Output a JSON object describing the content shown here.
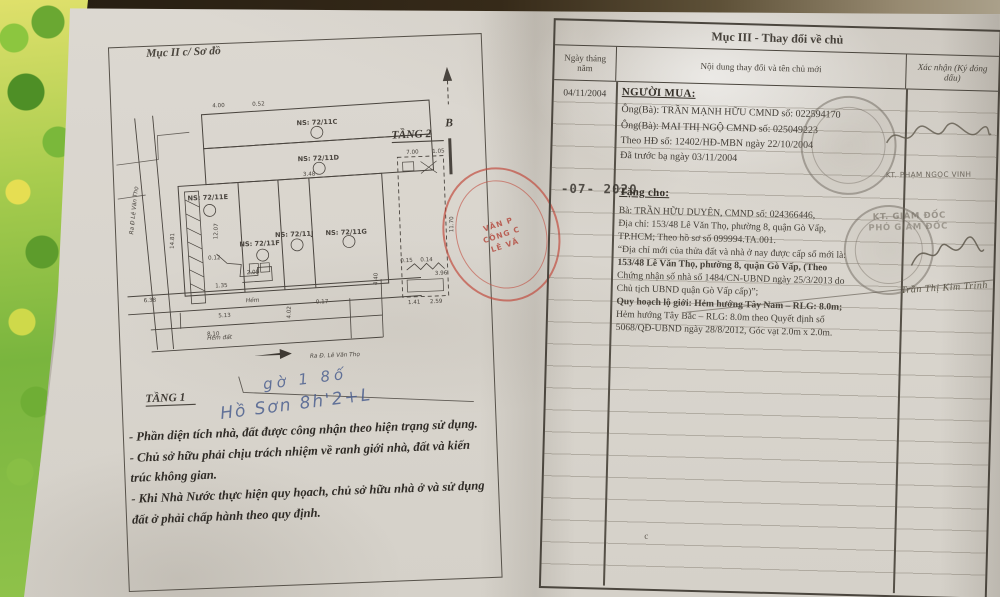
{
  "colors": {
    "paper": "#dcd8d1",
    "ink": "#3f3a33",
    "table_line": "#4b463e",
    "stamp_red": "#bf4a3f",
    "stamp_gray": "#7d776b",
    "handwriting_blue": "#44598c",
    "background_green": "#79b53e",
    "background_yellow": "#e4d94e"
  },
  "left_page": {
    "section_title": "Mục II c/ Sơ đồ",
    "floor1_label": "TẦNG 1",
    "floor2_label": "TẦNG 2",
    "north_label": "B",
    "street_label": "Ra Đ. Lê Văn Thọ",
    "road_label_vertical": "Ra Đ Lê Văn Thọ",
    "alley_label": "Hẻm",
    "alley_dirt_label": "Hẻm  đất",
    "rooms": [
      "NS: 72/11C",
      "NS: 72/11D",
      "NS: 72/11E",
      "NS: 72/11F",
      "NS: 72/11J",
      "NS: 72/11G"
    ],
    "dims": [
      "4.00",
      "0.52",
      "3.48",
      "14.81",
      "12.07",
      "6.38",
      "5.13",
      "0.17",
      "2.05",
      "1.35",
      "0.12",
      "4.02",
      "7.00",
      "1.05",
      "11.70",
      "0.15",
      "0.14",
      "3.96",
      "1.41",
      "2.59",
      "8.10",
      "4.40"
    ],
    "handwriting": [
      "gờ 1 8ố",
      "Hồ Sơn 8h'2+L"
    ],
    "stamp_partial_lines": [
      "VĂN P",
      "CÔNG C",
      "LÊ VĂ"
    ],
    "notes": [
      "- Phần diện tích nhà, đất được công nhận theo hiện trạng sử dụng.",
      "- Chủ sở hữu phải chịu trách nhiệm về ranh giới nhà, đất và kiến trúc không gian.",
      "- Khi Nhà Nước thực hiện quy họach, chủ sở hữu nhà ở và sử dụng đất ở phải chấp hành theo quy định."
    ]
  },
  "right_page": {
    "section_title": "Mục III - Thay đổi về chủ",
    "columns": [
      "Ngày tháng năm",
      "Nội dung thay đổi và tên chủ mới",
      "Xác nhận (Ký đóng dấu)"
    ],
    "stray_mark": "c",
    "entries": [
      {
        "date": "04/11/2004",
        "heading": "NGƯỜI MUA:",
        "lines": [
          "Ông(Bà): TRẦN MẠNH HỮU   CMND số: 022594170",
          "Ông(Bà): MAI THỊ NGỘ        CMND số: 025049223",
          "Theo HĐ số: 12402/HĐ-MBN  ngày 22/10/2004",
          "Đã trước bạ ngày 03/11/2004"
        ],
        "confirm_name": "KT. PHẠM NGỌC VINH"
      },
      {
        "date_stamp": "09 -07- 2020",
        "heading": "Tặng cho:",
        "lines": [
          "Bà: TRẦN HỮU DUYÊN, CMND số: 024366446,",
          "Địa chỉ: 153/48 Lê Văn Thọ, phường 8, quận Gò Vấp,",
          "TP.HCM; Theo hồ sơ số 099994.TA.001.",
          "“Địa chỉ mới của thửa đất và nhà ở nay được cấp số mới là:",
          "153/48 Lê Văn Thọ, phường 8, quận Gò Vấp, (Theo",
          "Chứng nhận số nhà số 1484/CN-UBND ngày 25/3/2013 do",
          "Chủ tịch UBND quận Gò Vấp cấp)”;",
          "Quy hoạch lộ giới: Hẻm hướng Tây Nam – RLG: 8.0m;",
          "Hẻm hướng Tây Bắc – RLG: 8.0m theo Quyết định số",
          "5068/QĐ-UBND ngày 28/8/2012, Góc vạt 2.0m x 2.0m."
        ],
        "confirm_title1": "KT. GIÁM ĐỐC",
        "confirm_title2": "PHÓ GIÁM ĐỐC",
        "confirm_signature": "Trần Thị Kim Trinh"
      }
    ]
  }
}
